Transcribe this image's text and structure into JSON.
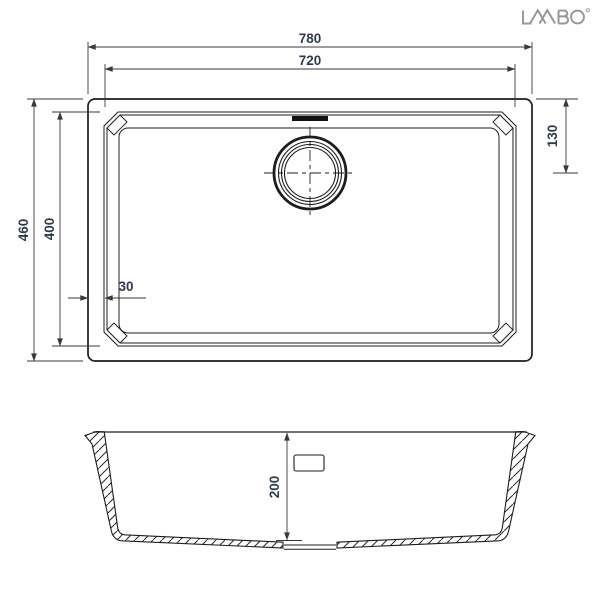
{
  "brand": {
    "name": "LAVABO"
  },
  "colors": {
    "line": "#1d1d1f",
    "dimension_line": "#3a3a3a",
    "dimension_text": "#2e3b4e",
    "logo": "#94999c",
    "background": "#ffffff"
  },
  "top_view": {
    "dims": {
      "outer_width": "780",
      "inner_width": "720",
      "outer_depth": "460",
      "inner_depth": "400",
      "drain_from_top": "130",
      "rim_width": "30"
    }
  },
  "section_view": {
    "dims": {
      "bowl_depth": "200"
    }
  }
}
